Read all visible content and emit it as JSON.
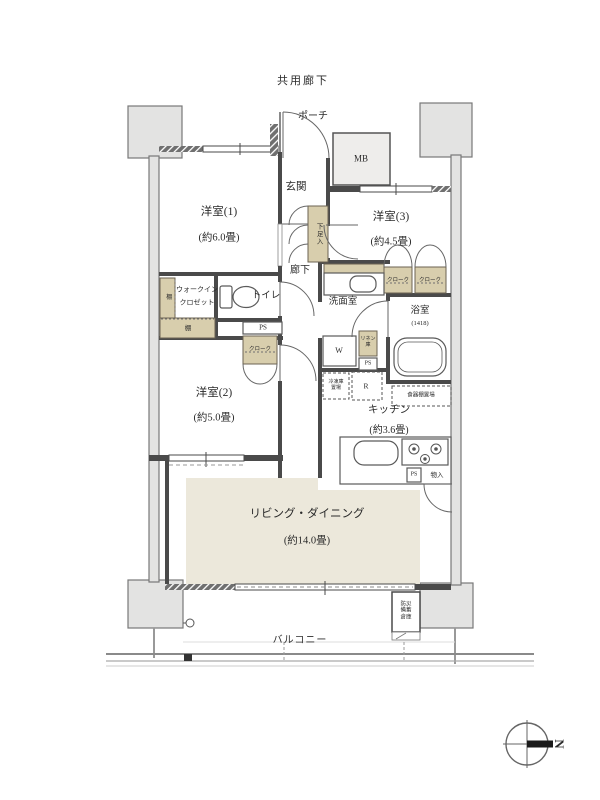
{
  "plan": {
    "common_corridor": "共用廊下",
    "porch": "ポーチ",
    "meter_box": "MB",
    "entrance": "玄関",
    "shoe_box": "下足入",
    "bedroom1": {
      "name": "洋室(1)",
      "size": "(約6.0畳)"
    },
    "bedroom2": {
      "name": "洋室(2)",
      "size": "(約5.0畳)"
    },
    "bedroom3": {
      "name": "洋室(3)",
      "size": "(約4.5畳)"
    },
    "closet": "クローク",
    "corridor": "廊下",
    "wic": {
      "line1": "ウォークイン",
      "line2": "クロゼット",
      "shelf": "棚"
    },
    "toilet": "トイレ",
    "ps": "PS",
    "washroom": "洗面室",
    "washer": "W",
    "linen": "リネン庫",
    "bathroom": {
      "name": "浴室",
      "size": "(1418)"
    },
    "freezer_space": "冷凍庫置場",
    "refrigerator": "R",
    "cupboard_space": "食器棚置場",
    "kitchen": {
      "name": "キッチン",
      "size": "(約3.6畳)"
    },
    "storage": "物入",
    "living_dining": {
      "name": "リビング・ダイニング",
      "size": "(約14.0畳)"
    },
    "disaster_storage": "防災備蓄倉庫",
    "balcony": "バルコニー",
    "compass_north": "N"
  },
  "colors": {
    "wall": "#4a4a4a",
    "closet_beige": "#d8cead",
    "floor_beige": "#ece8db",
    "pillar_gray": "#e3e3e2",
    "text": "#2b2b2b"
  }
}
